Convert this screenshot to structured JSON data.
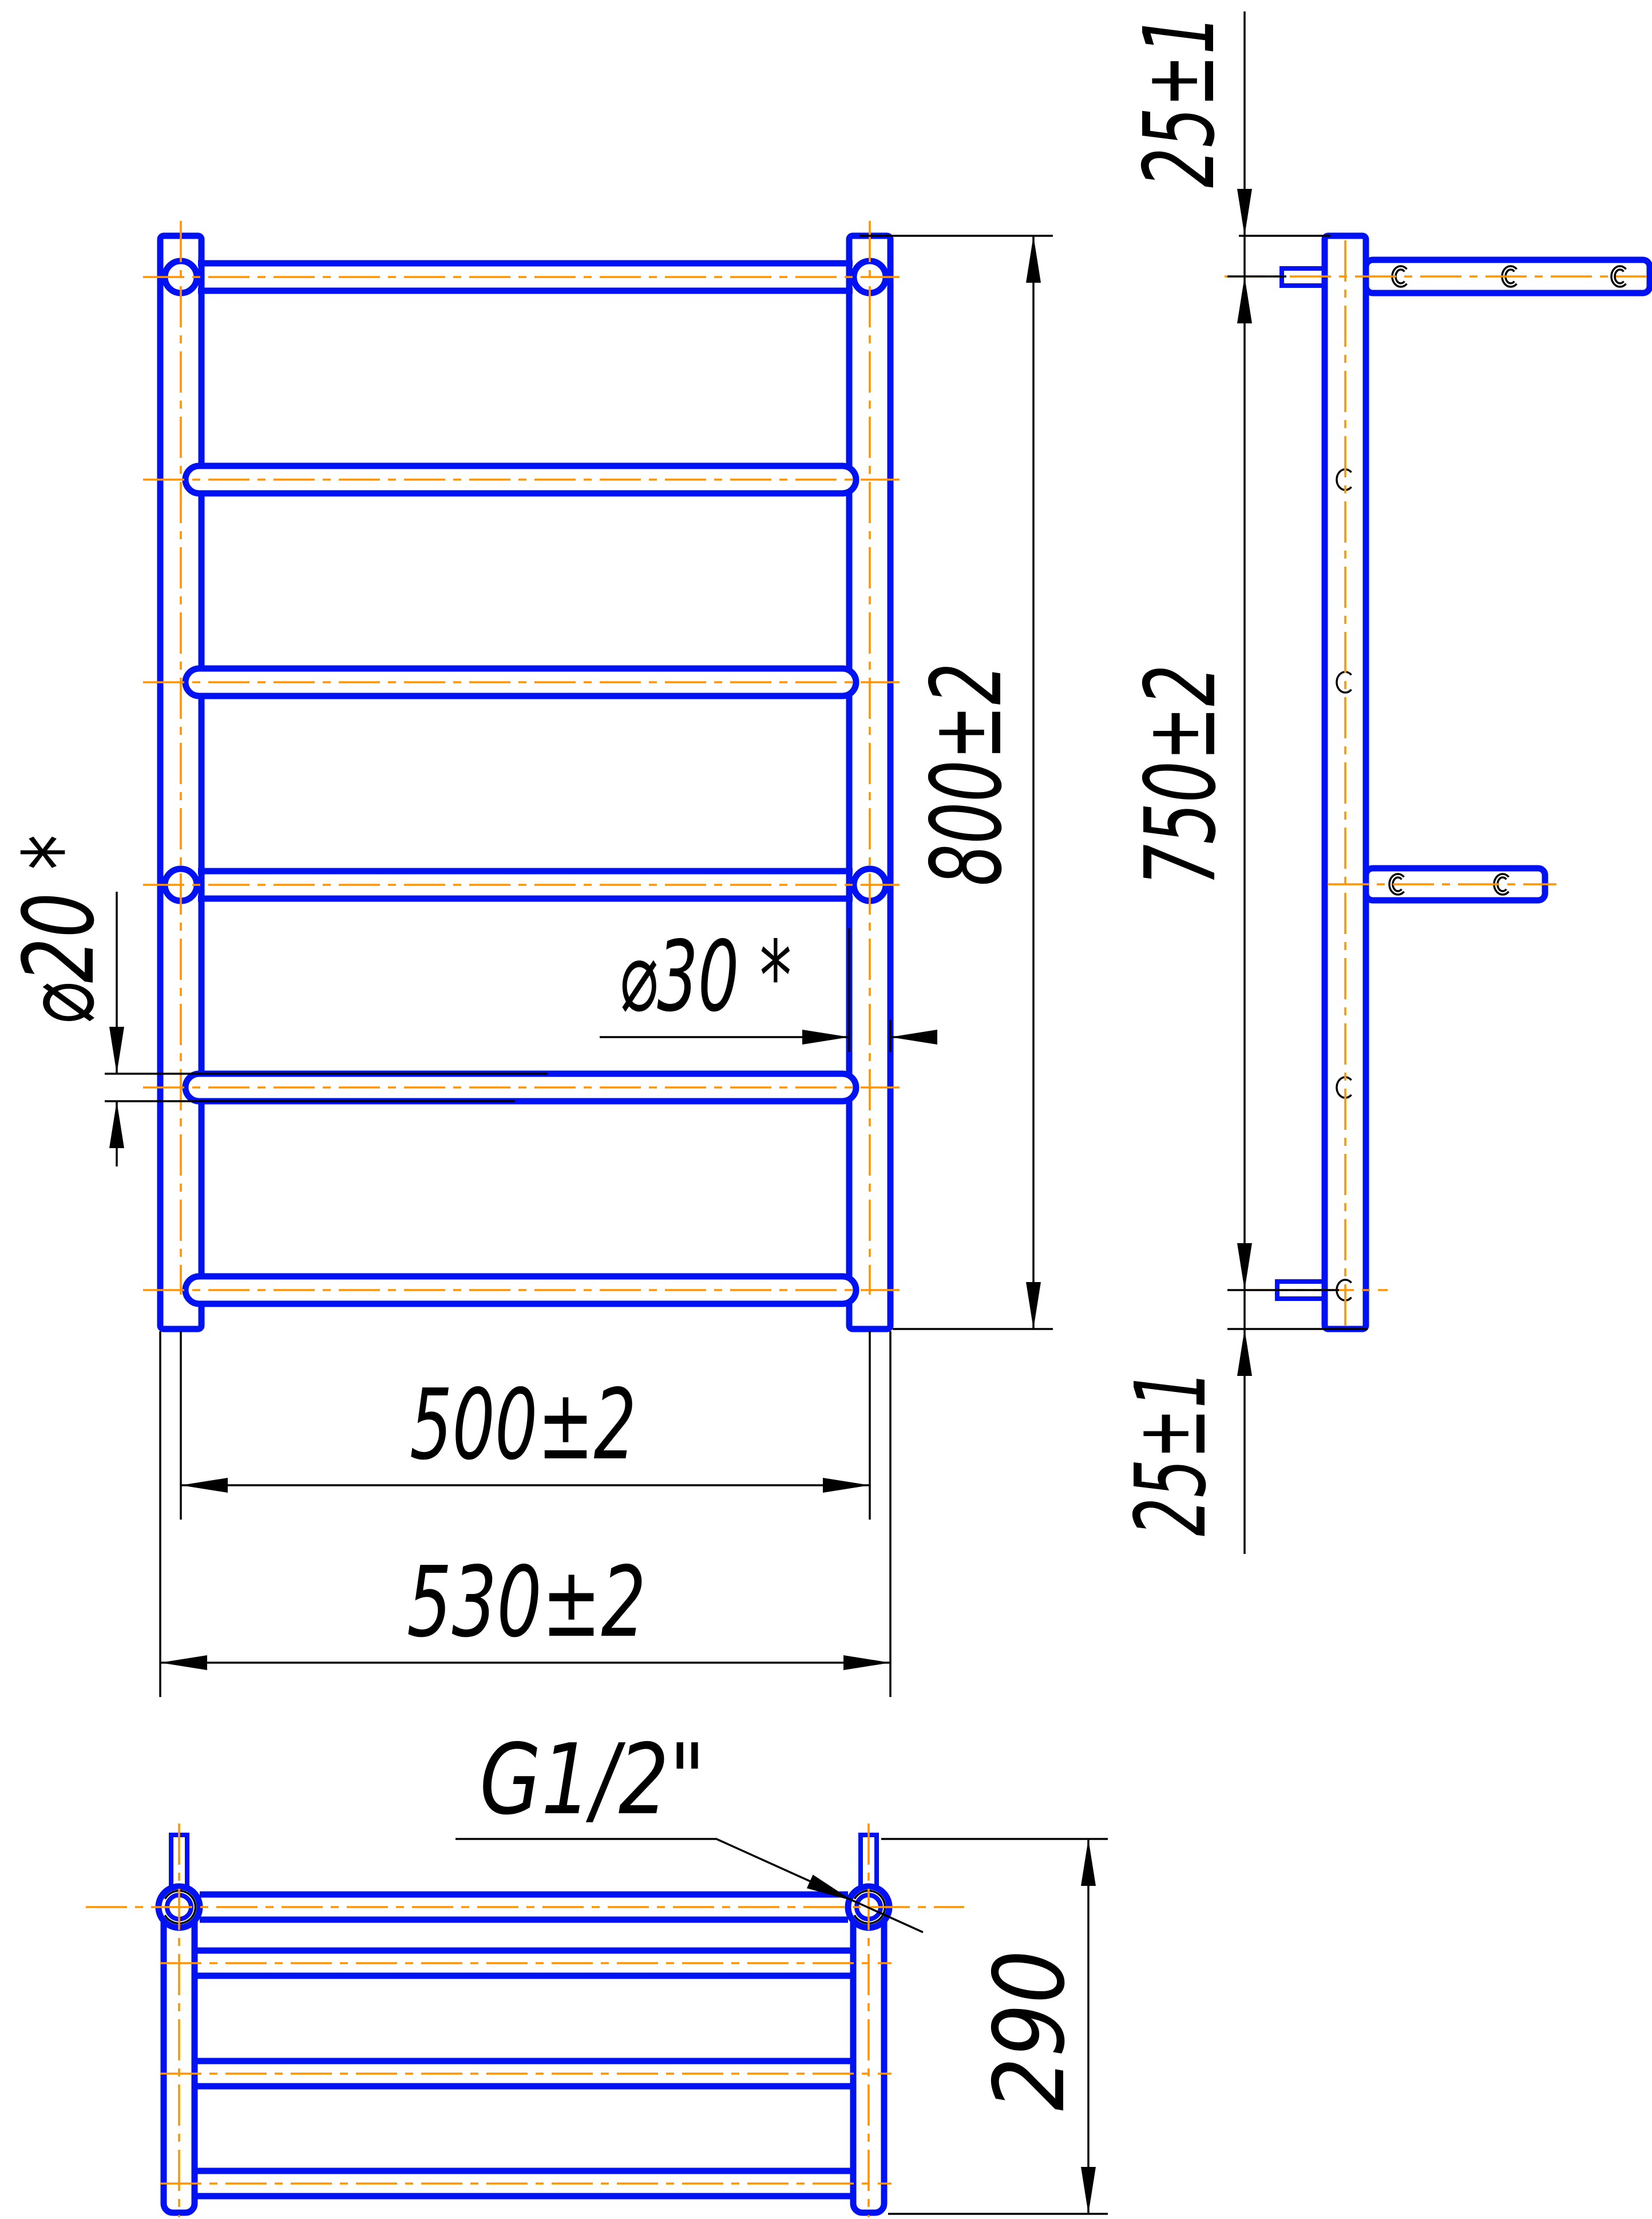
{
  "title": "Heated towel rail — dimensioned engineering drawing (front, side and bottom views)",
  "colors": {
    "outline": "#0011f2",
    "centerline": "#ff9400",
    "dimension": "#000000",
    "background": "#ffffff"
  },
  "views": {
    "front": "front view",
    "side": "side view",
    "bottom": "bottom view"
  },
  "structure": {
    "horizontal_bars": 6,
    "vertical_posts": 2,
    "wall_arms_in_side_view": 2,
    "pipe_stubs_in_side_view": 2,
    "bar_rows_in_bottom_view": 4
  },
  "labels": {
    "height_overall": "800±2",
    "bracket_span": "750±2",
    "offset_top": "25±1",
    "offset_bottom": "25±1",
    "width_centers": "500±2",
    "width_overall": "530±2",
    "depth": "290",
    "bar_diameter": "⌀20 *",
    "post_diameter": "⌀30 *",
    "thread": "G1/2\""
  }
}
